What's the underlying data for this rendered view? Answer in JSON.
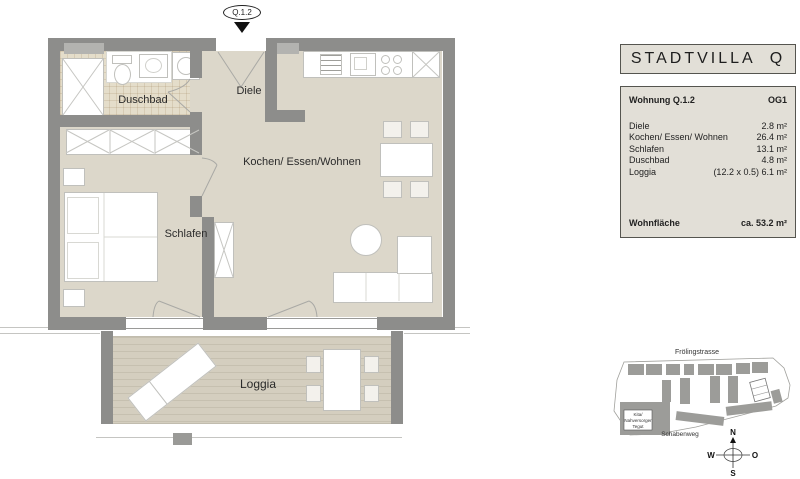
{
  "entrance_marker": {
    "label": "Q.1.2"
  },
  "floor_plan": {
    "rooms": {
      "diele": "Diele",
      "duschbad": "Duschbad",
      "schlafen": "Schlafen",
      "wohnen": "Kochen/ Essen/Wohnen",
      "loggia": "Loggia"
    }
  },
  "title_box": {
    "title": "STADTVILLA  Q"
  },
  "info_panel": {
    "unit_label": "Wohnung Q.1.2",
    "floor_label": "OG1",
    "rows": [
      {
        "name": "Diele",
        "note": "",
        "value": "2.8 m²"
      },
      {
        "name": "Kochen/ Essen/ Wohnen",
        "note": "",
        "value": "26.4 m²"
      },
      {
        "name": "Schlafen",
        "note": "",
        "value": "13.1 m²"
      },
      {
        "name": "Duschbad",
        "note": "",
        "value": "4.8 m²"
      },
      {
        "name": "Loggia",
        "note": "(12.2 x 0.5)",
        "value": "6.1 m²"
      }
    ],
    "total_label": "Wohnfläche",
    "total_value": "ca. 53.2 m²"
  },
  "site_plan": {
    "street_top": "Frölingstrasse",
    "street_bottom": "Schabenweg",
    "poi": {
      "line1": "Kita/",
      "line2": "Nahversorger",
      "line3": "Tegut"
    },
    "compass": {
      "north": "N",
      "east": "O",
      "south": "S",
      "west": "W"
    }
  },
  "colors": {
    "wall": "#8d8d8b",
    "floor": "#dcd7ca",
    "tile": "#e4ddca",
    "deck": "#d4cebf",
    "panel": "#e2dfd7"
  }
}
